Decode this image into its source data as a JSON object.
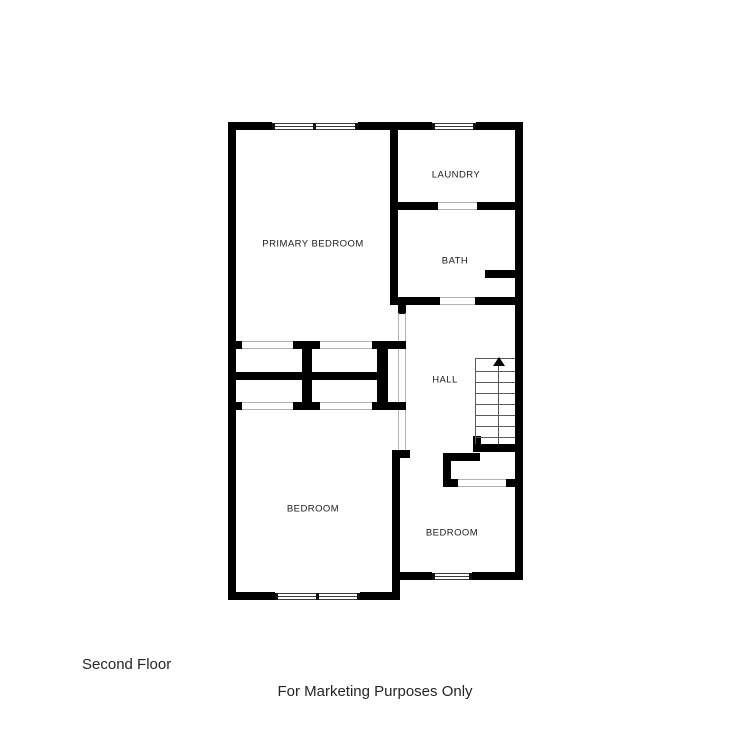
{
  "plan": {
    "rooms": [
      {
        "label": "PRIMARY BEDROOM"
      },
      {
        "label": "LAUNDRY"
      },
      {
        "label": "BATH"
      },
      {
        "label": "HALL"
      },
      {
        "label": "BEDROOM"
      },
      {
        "label": "BEDROOM"
      }
    ],
    "stairs": {
      "direction": "up"
    }
  },
  "footer": {
    "floor_label": "Second Floor",
    "disclaimer": "For Marketing Purposes Only"
  },
  "colors": {
    "wall": "#000000",
    "background": "#ffffff",
    "label_text": "#1c1c1c",
    "footer_text": "#252525",
    "opening_line": "#b3b3b3",
    "stair_line": "#5a5a5a"
  }
}
